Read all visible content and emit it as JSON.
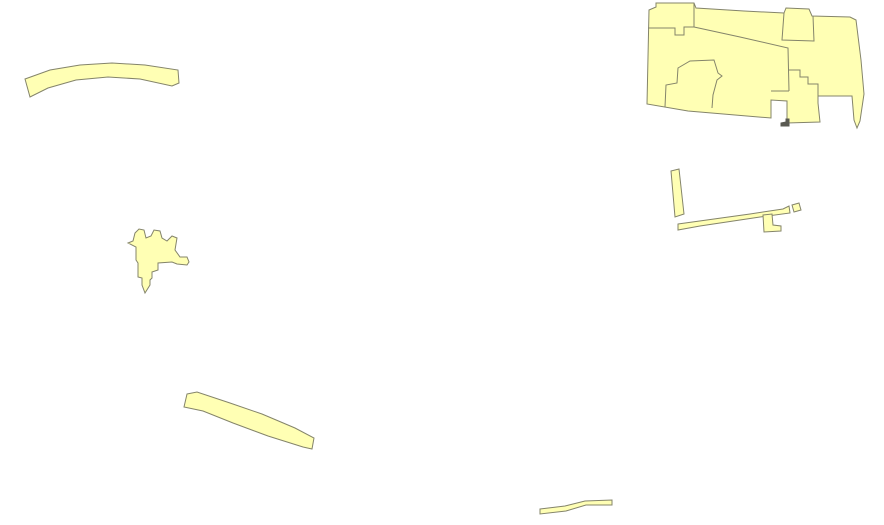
{
  "map": {
    "canvas": {
      "width": 884,
      "height": 525,
      "background_color": "#ffffff"
    },
    "symbology": {
      "polygon_fill_color": "#ffffb4",
      "polygon_outline_color": "#84846a",
      "polygon_outline_width": 1,
      "sliver_fill_color": "#5a5a52"
    },
    "features": [
      {
        "name": "parcel-strip-northwest",
        "kind": "polygon",
        "d": "M 25,79 L 50,70 L 80,65 L 112,63 L 145,65 L 178,70 L 179,83 L 172,86 L 140,79 L 108,77 L 76,80 L 48,88 L 30,97 Z"
      },
      {
        "name": "parcel-block-northeast-outer",
        "kind": "polygon",
        "d": "M 649,10 L 656,7 L 656,3 L 694,3 L 696,8 L 744,11 L 784,13 L 786,8 L 809,9 L 812,16 L 850,17 L 856,20 L 861,60 L 864,94 L 860,121 L 857,128 L 854,120 L 852,96 L 818,96 L 818,103 L 820,122 L 787,123 L 787,101 L 771,100 L 771,118 L 688,111 L 647,104 Z"
      },
      {
        "name": "parcel-boundary-northeast-top-left",
        "kind": "line",
        "d": "M 648,28 L 675,28 L 675,35 L 684,35 L 684,27 L 694,27 L 694,3"
      },
      {
        "name": "parcel-boundary-northeast-diagonal",
        "kind": "line",
        "d": "M 694,27 L 740,37 L 788,48 L 789,91"
      },
      {
        "name": "parcel-boundary-northeast-steps",
        "kind": "line",
        "d": "M 789,70 L 800,70 L 800,77 L 808,77 L 808,84 L 818,84 L 818,96"
      },
      {
        "name": "parcel-boundary-northeast-upper-box",
        "kind": "line",
        "d": "M 784,13 L 782,40 L 814,41 L 813,16"
      },
      {
        "name": "parcel-boundary-northeast-lower-left",
        "kind": "line",
        "d": "M 665,107 L 666,85 L 677,83 L 678,68 L 690,61 L 714,60 L 718,73 L 722,76 L 717,80 L 713,95 L 712,108"
      },
      {
        "name": "parcel-boundary-northeast-notch-top",
        "kind": "line",
        "d": "M 771,91 L 789,91"
      },
      {
        "name": "parcel-sliver-dark-mark",
        "kind": "dark",
        "d": "M 781,123 L 786,122 L 786,119 L 789,119 L 789,126 L 781,126 Z"
      },
      {
        "name": "parcel-strip-east-vertical",
        "kind": "polygon",
        "d": "M 671,171 L 679,169 L 684,214 L 675,217 Z"
      },
      {
        "name": "parcel-strip-east-long",
        "kind": "polygon",
        "d": "M 678,224 L 750,214 L 783,209 L 789,206 L 790,213 L 760,217 L 700,226 L 678,230 Z"
      },
      {
        "name": "parcel-east-l-shape",
        "kind": "polygon",
        "d": "M 763,215 L 772,214 L 773,225 L 781,226 L 781,231 L 764,232 Z"
      },
      {
        "name": "parcel-east-small-square",
        "kind": "polygon",
        "d": "M 792,205 L 799,203 L 801,210 L 794,212 Z"
      },
      {
        "name": "parcel-blob-west",
        "kind": "polygon",
        "d": "M 128,243 L 133,241 L 135,233 L 139,229 L 144,230 L 146,238 L 151,236 L 154,230 L 160,231 L 162,238 L 167,241 L 172,236 L 177,238 L 175,250 L 180,257 L 187,257 L 189,262 L 187,265 L 177,264 L 172,262 L 158,263 L 158,270 L 152,272 L 152,278 L 150,280 L 150,285 L 145,293 L 142,285 L 142,278 L 138,277 L 138,263 L 136,260 L 136,247 Z"
      },
      {
        "name": "parcel-strip-southwest",
        "kind": "polygon",
        "d": "M 187,394 L 197,392 L 230,403 L 262,414 L 295,428 L 314,438 L 312,449 L 303,447 L 268,436 L 233,423 L 203,411 L 184,407 Z"
      },
      {
        "name": "parcel-strip-south",
        "kind": "polygon",
        "d": "M 540,509 L 565,506 L 585,501 L 612,500 L 612,505 L 586,505 L 566,511 L 540,514 Z"
      }
    ]
  }
}
